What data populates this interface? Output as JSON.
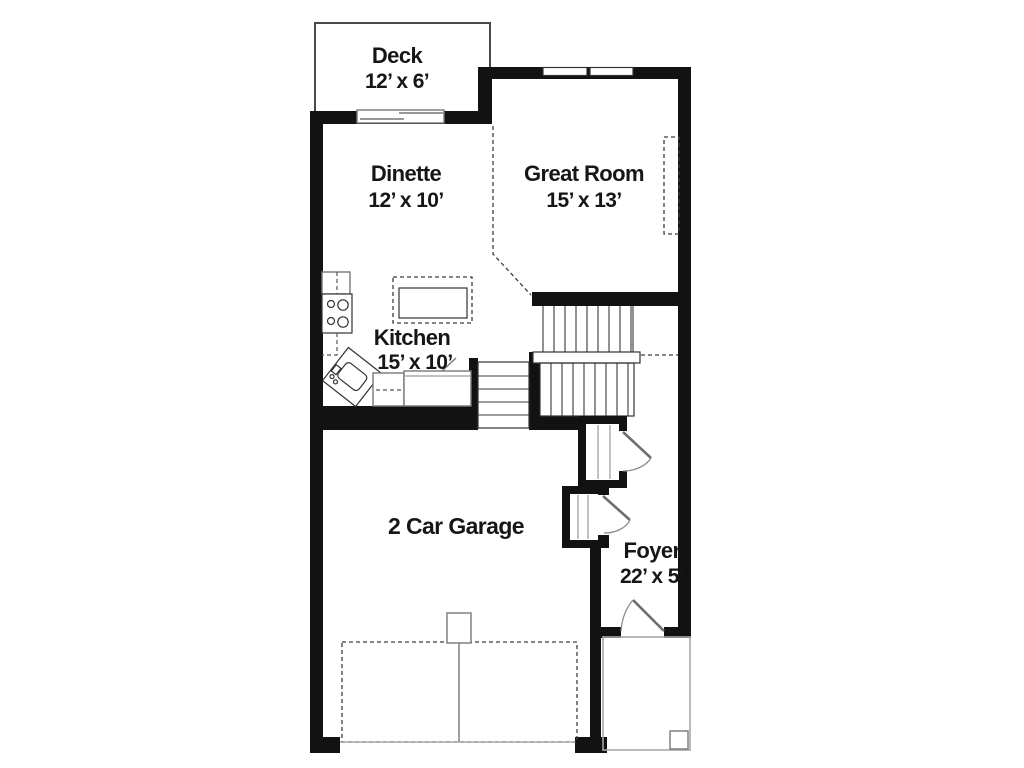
{
  "plan": {
    "rooms": {
      "deck": {
        "name": "Deck",
        "dims": "12’ x 6’"
      },
      "dinette": {
        "name": "Dinette",
        "dims": "12’ x 10’"
      },
      "great_room": {
        "name": "Great Room",
        "dims": "15’ x 13’"
      },
      "kitchen": {
        "name": "Kitchen",
        "dims": "15’ x 10’"
      },
      "garage": {
        "name": "2 Car Garage"
      },
      "foyer": {
        "name": "Foyer",
        "dims": "22’ x 5’"
      }
    }
  },
  "colors": {
    "background": "#ffffff",
    "wall": "#121212",
    "outline": "#4a4a4a",
    "light_outline": "#9a9a9a",
    "door": "#777777",
    "text": "#161616"
  }
}
